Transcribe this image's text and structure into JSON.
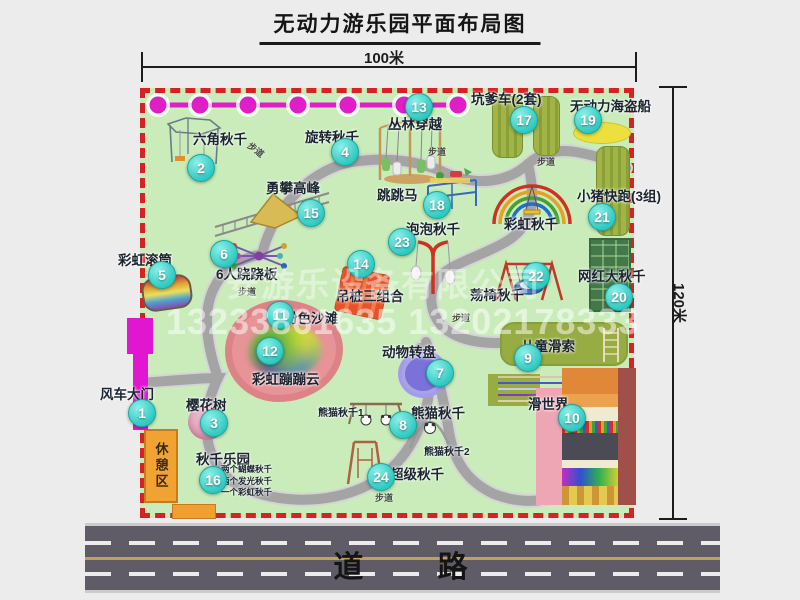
{
  "title": "无动力游乐园平面布局图",
  "dimensions": {
    "width": "100米",
    "height": "120米"
  },
  "watermarks": {
    "company": "安游乐设备有限公司",
    "phone": "13233861635 13202178333"
  },
  "road_label": "道 路",
  "path_label": "步道",
  "rest_area_label": "休憩区",
  "rainbow_swing_label": "彩虹秋千",
  "attractions": {
    "a1": {
      "num": "1",
      "label": "风车大门"
    },
    "a2": {
      "num": "2",
      "label": "六角秋千"
    },
    "a3": {
      "num": "3",
      "label": "樱花树"
    },
    "a4": {
      "num": "4",
      "label": "旋转秋千"
    },
    "a5": {
      "num": "5",
      "label": "彩虹滚筒"
    },
    "a6": {
      "num": "6",
      "label": "6人跷跷板"
    },
    "a7": {
      "num": "7",
      "label": "动物转盘"
    },
    "a8": {
      "num": "8",
      "label": "熊猫秋千"
    },
    "a9": {
      "num": "9",
      "label": "儿童滑索"
    },
    "a10": {
      "num": "10",
      "label": "滑世界"
    },
    "a11": {
      "num": "11",
      "label": "粉色沙滩"
    },
    "a12": {
      "num": "12",
      "label": "彩虹蹦蹦云"
    },
    "a13": {
      "num": "13",
      "label": "丛林穿越"
    },
    "a14": {
      "num": "14",
      "label": "吊桩三组合"
    },
    "a15": {
      "num": "15",
      "label": "勇攀高峰"
    },
    "a16": {
      "num": "16",
      "label": "秋千乐园"
    },
    "a17": {
      "num": "17",
      "label": "坑爹车(2套)"
    },
    "a18": {
      "num": "18",
      "label": "跳跳马"
    },
    "a19": {
      "num": "19",
      "label": "无动力海盗船"
    },
    "a20": {
      "num": "20",
      "label": "网红大秋千"
    },
    "a21": {
      "num": "21",
      "label": "小猪快跑(3组)"
    },
    "a22": {
      "num": "22",
      "label": "荡椅秋千"
    },
    "a23": {
      "num": "23",
      "label": "泡泡秋千"
    },
    "a24": {
      "num": "24",
      "label": "超级秋千"
    }
  },
  "sub_labels": {
    "panda1": "熊猫秋千1",
    "panda2": "熊猫秋千2",
    "swing_park_items": [
      "两个蝴蝶秋千",
      "两个发光秋千",
      "一个彩虹秋千"
    ]
  },
  "colors": {
    "park_green": "#c9ecba",
    "border_red": "#d62222",
    "marker_cyan": "#2ec8c0",
    "chain_magenta": "#e01ec8",
    "road_gray": "#5f5c67",
    "rest_orange": "#f0a233"
  }
}
